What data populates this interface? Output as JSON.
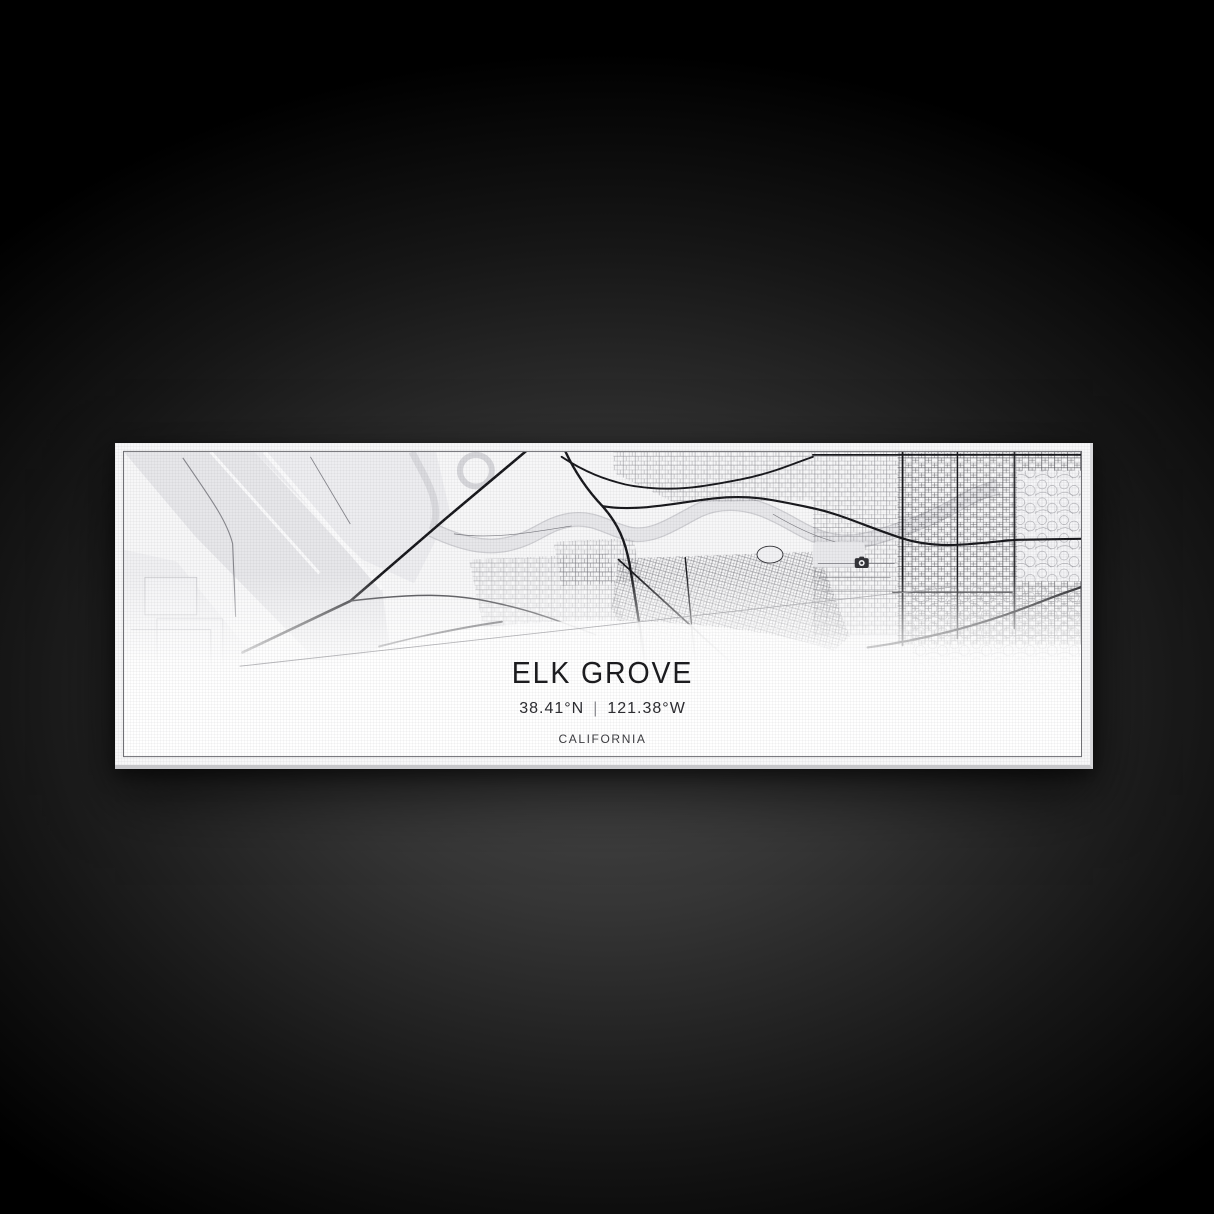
{
  "scene": {
    "backdrop_center_color": "#4c4c4c",
    "backdrop_edge_color": "#000000"
  },
  "artwork": {
    "kind": "panoramic city map canvas print",
    "title": "ELK GROVE",
    "coordinates": {
      "latitude": "38.41°N",
      "separator": "|",
      "longitude": "121.38°W"
    },
    "state": "CALIFORNIA",
    "palette": {
      "canvas": "#f7f7f8",
      "water_fields": "#e7e7ea",
      "river": "#e7e7ea",
      "road_major": "#17171b",
      "road_minor": "#77777d",
      "border_line": "#6d6d72",
      "text": "#1c1c1f"
    },
    "map_icons": [
      {
        "name": "camera-icon"
      }
    ]
  }
}
